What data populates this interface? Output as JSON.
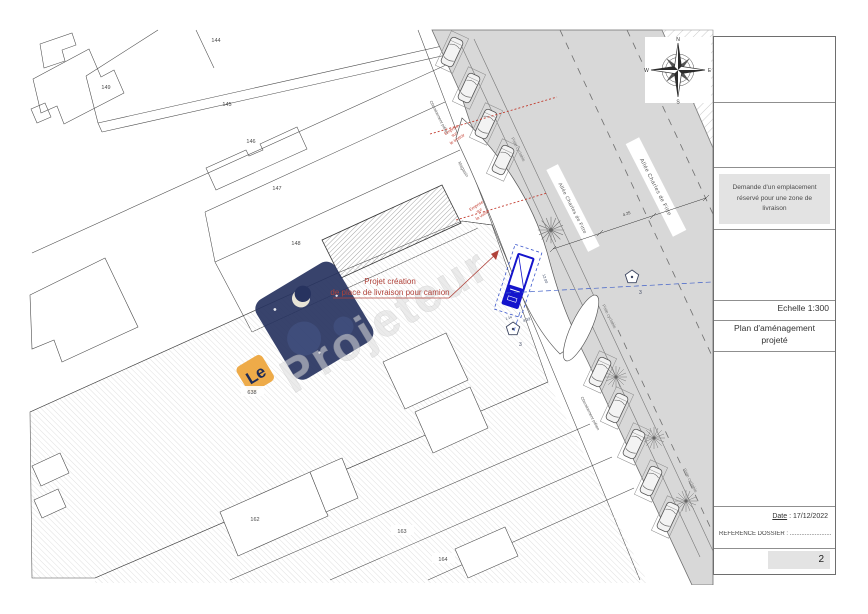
{
  "plan": {
    "parcels": {
      "n144": "144",
      "n145": "145",
      "n146": "146",
      "n147": "147",
      "n148": "148",
      "n149": "149",
      "n638": "638",
      "n162": "162",
      "n163": "163",
      "n164": "164"
    },
    "streets": {
      "allee": "Allée Charles de Fitte",
      "piste": "Piste cyclable",
      "chemin": "Cheminement piéton",
      "magasin": "Magasin"
    },
    "compass": {
      "n": "N",
      "e": "E",
      "s": "S",
      "w": "W"
    },
    "callout": {
      "line1": "Projet création",
      "line2": "de place de livraison pour camion"
    },
    "emprise_trottoir": {
      "w1": "Emprise",
      "w2": "sur",
      "w3": "le trottoir"
    },
    "emprise_voirie": {
      "w1": "Emprise",
      "w2": "sur",
      "w3": "la voirie"
    },
    "tree_label": "3",
    "dims": {
      "bay_length": "12.00",
      "bay_width": "4.33",
      "bay_offset": "1.14",
      "road_width": "4.25"
    },
    "watermark": {
      "le": "Le",
      "name": "Projeteur"
    }
  },
  "titleblock": {
    "notice": "Demande d'un emplacement réservé pour une zone de livraison",
    "scale": "Echelle 1:300",
    "title": "Plan d'aménagement projeté",
    "date_label": "Date",
    "date_value": " : 17/12/2022",
    "reference": "REFERENCE DOSSIER : ...............................",
    "page": "2"
  },
  "colors": {
    "street": "#d8d8d8",
    "accent_blue": "#1414cc",
    "annotation_red": "#b0423a"
  }
}
